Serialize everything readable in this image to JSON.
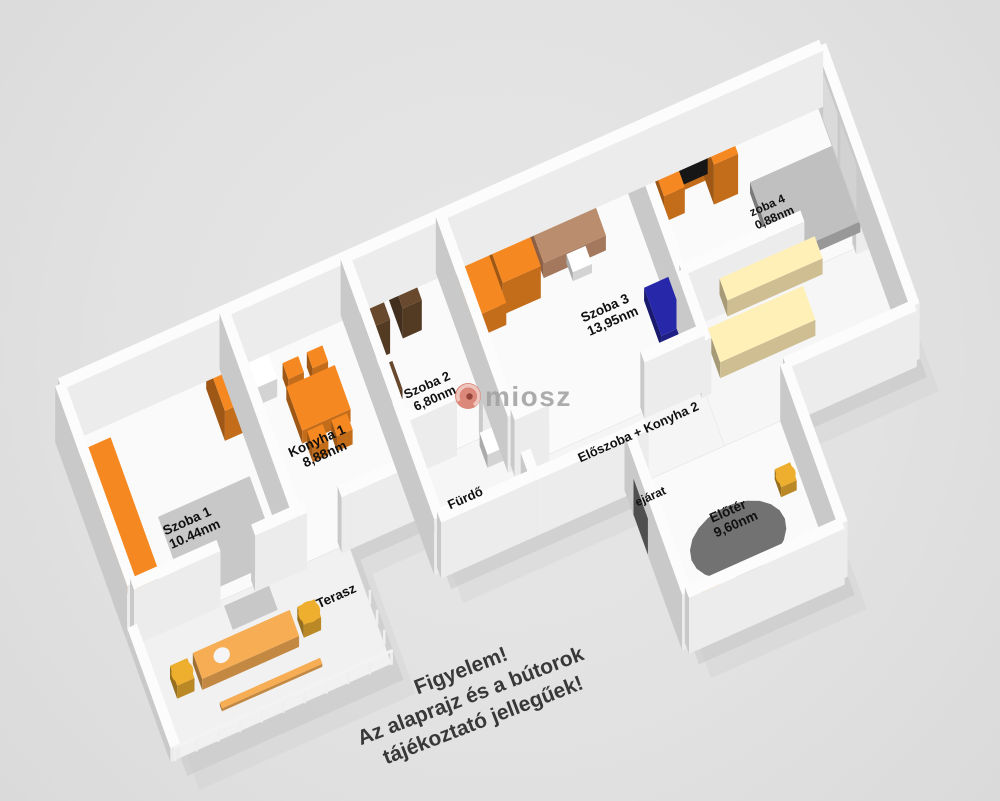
{
  "figure_type": "3d-floorplan",
  "rooms": {
    "szoba1": {
      "name": "Szoba 1",
      "area": "10.44nm"
    },
    "konyha1": {
      "name": "Konyha 1",
      "area": "8,88nm"
    },
    "szoba2": {
      "name": "Szoba 2",
      "area": "6,80nm"
    },
    "szoba3": {
      "name": "Szoba 3",
      "area": "13,95nm"
    },
    "szoba4": {
      "name": "zoba 4",
      "area": "0,88nm"
    },
    "eloszoba": {
      "name": "Előszoba + Konyha 2"
    },
    "furdo": {
      "name": "Fürdő"
    },
    "terasz": {
      "name": "Terasz"
    },
    "eloter": {
      "name": "Előtér",
      "area": "9,60nm"
    },
    "entrance": {
      "name": "ejárat"
    }
  },
  "watermark": {
    "brand": "miosz",
    "logo": "swirl-logo"
  },
  "disclaimer": {
    "line1": "Figyelem!",
    "line2": "Az alaprajz és a bútorok",
    "line3": "tájékoztató jellegűek!"
  },
  "colors": {
    "background": "#e2e2e2",
    "wall_top": "#fcfcfc",
    "wall_light": "#ececec",
    "wall_dark": "#c9c9c9",
    "floor": "#fafafa",
    "terrace_floor": "#f1f1f1",
    "corridor_floor": "#f5f5f5",
    "rug": "#c5c5c5",
    "dark_rug": "#666666",
    "shadow": "#c6c6c6",
    "orange": "#e8801f",
    "terrace_orange": "#e8a34e",
    "cream": "#f5e2ae",
    "brown": "#63452a",
    "blue": "#2525a0",
    "gray_furniture": "#b5b5b5",
    "white_furniture": "#fbfbfb",
    "yellow": "#dda22b",
    "black": "#161616",
    "door": "#4f4f4f",
    "label": "#111111",
    "watermark_text": "#a2a2a2",
    "watermark_logo": "#d0604e",
    "disclaimer_text": "#383838"
  }
}
